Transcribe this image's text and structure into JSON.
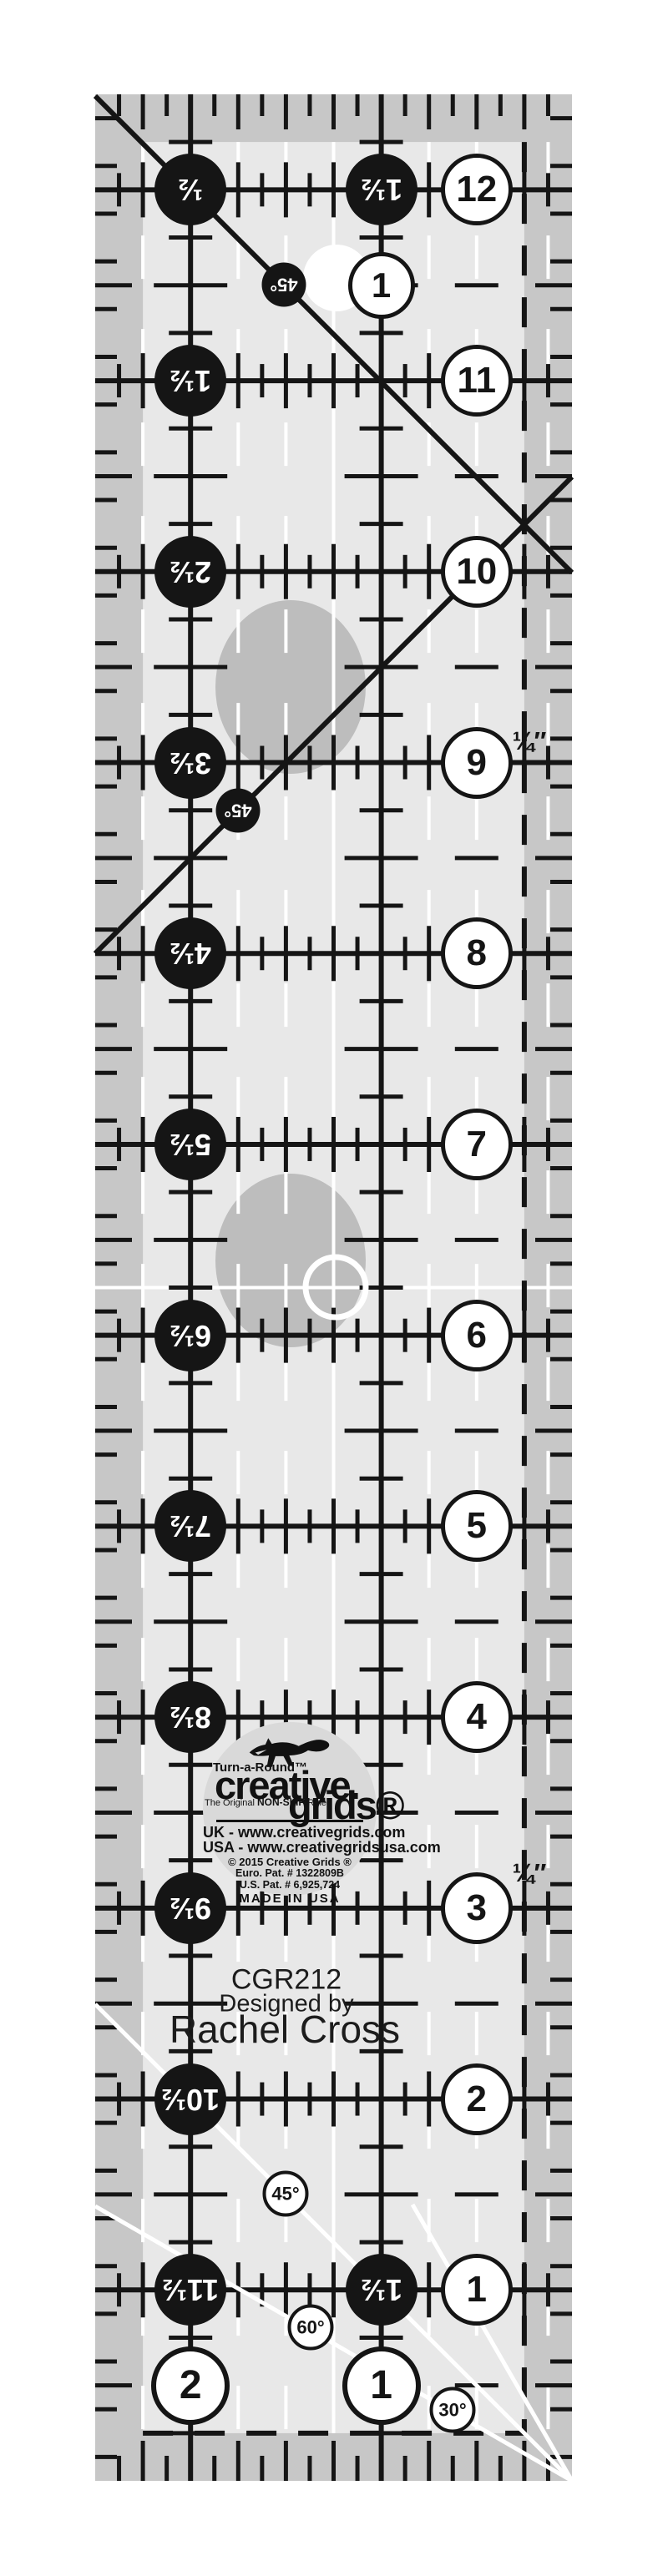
{
  "colors": {
    "ink": "#151515",
    "field": "#e8e8e8",
    "band": "#c7c7c7",
    "dot_gray": "#bdbdbd",
    "badge_gray": "#d9d9d9",
    "white_line": "#ffffff"
  },
  "ruler": {
    "left_labels": [
      "½",
      "1½",
      "2½",
      "3½",
      "4½",
      "5½",
      "6½",
      "7½",
      "8½",
      "9½",
      "10½",
      "11½"
    ],
    "right_labels": [
      "12",
      "11",
      "10",
      "9",
      "8",
      "7",
      "6",
      "5",
      "4",
      "3",
      "2",
      "1"
    ],
    "top_black_column_label": "1½",
    "top_white_column_label": "1",
    "bottom_black_column_label": "1½",
    "bottom_white_labels": [
      "2",
      "1"
    ],
    "diagonal_dot_labels": [
      "45°",
      "45°"
    ],
    "angle_circle_labels": [
      "45°",
      "60°",
      "30°"
    ],
    "quarter_inch_labels": [
      "¼″",
      "¼″"
    ],
    "model": "CGR212",
    "designed_by": "Designed by",
    "designer": "Rachel Cross"
  },
  "logo": {
    "brand_top": "Turn-a-Round™",
    "brand_main_1": "creative.",
    "brand_main_2": "grids®",
    "tagline_pre": "The Original ",
    "tagline_bold": "NON-SLIP",
    "tagline_post": " Ruler",
    "uk_line": "UK - www.creativegrids.com",
    "usa_line": "USA - www.creativegridsusa.com",
    "copyright": "© 2015  Creative Grids ®",
    "euro_patent": "Euro. Pat. # 1322809B",
    "us_patent": "U.S. Pat. # 6,925,724",
    "made_in": "MADE IN USA"
  }
}
